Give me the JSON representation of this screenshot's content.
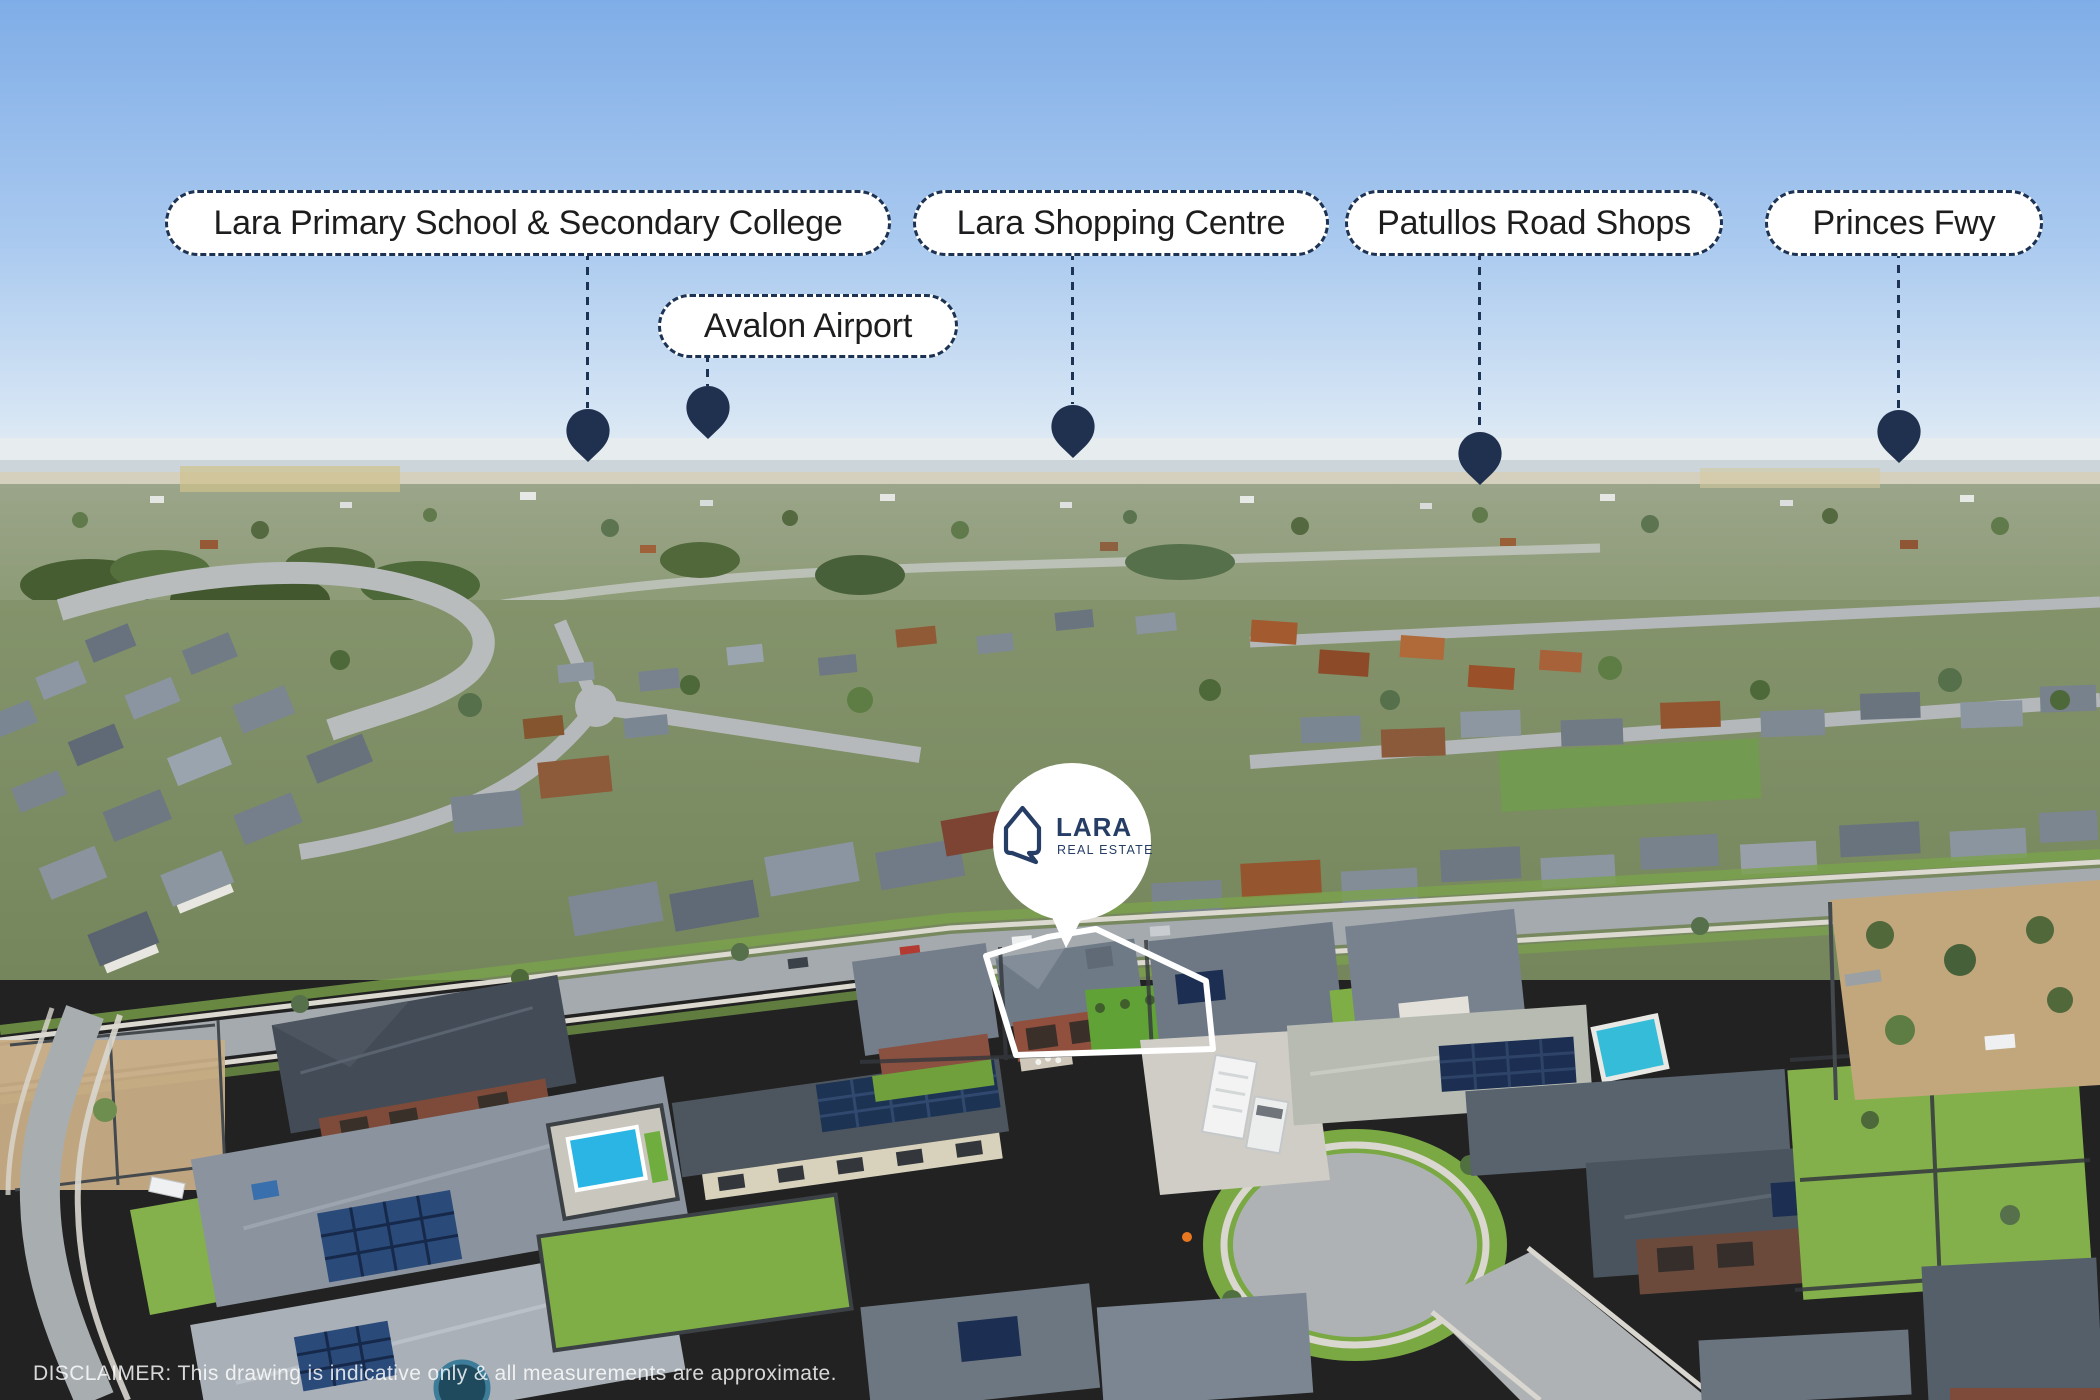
{
  "overlay": {
    "labels": [
      {
        "id": "school",
        "text": "Lara Primary School & Secondary College"
      },
      {
        "id": "shopping",
        "text": "Lara Shopping Centre"
      },
      {
        "id": "patullos",
        "text": "Patullos Road Shops"
      },
      {
        "id": "princes",
        "text": "Princes Fwy"
      },
      {
        "id": "avalon",
        "text": "Avalon Airport"
      }
    ],
    "pin_count": 5
  },
  "marker": {
    "brand_name": "LARA",
    "brand_tagline": "REAL ESTATE"
  },
  "footer": {
    "disclaimer": "DISCLAIMER: This drawing is indicative only & all measurements are approximate."
  },
  "icons": {
    "pin": "location-pin",
    "logo": "house-outline"
  },
  "colors": {
    "pin_navy": "#203150",
    "label_border_navy": "#1d3354",
    "label_text": "#1d1d1f",
    "brand_navy": "#263e66",
    "marker_white": "#ffffff",
    "sky_top": "#7fade7"
  }
}
